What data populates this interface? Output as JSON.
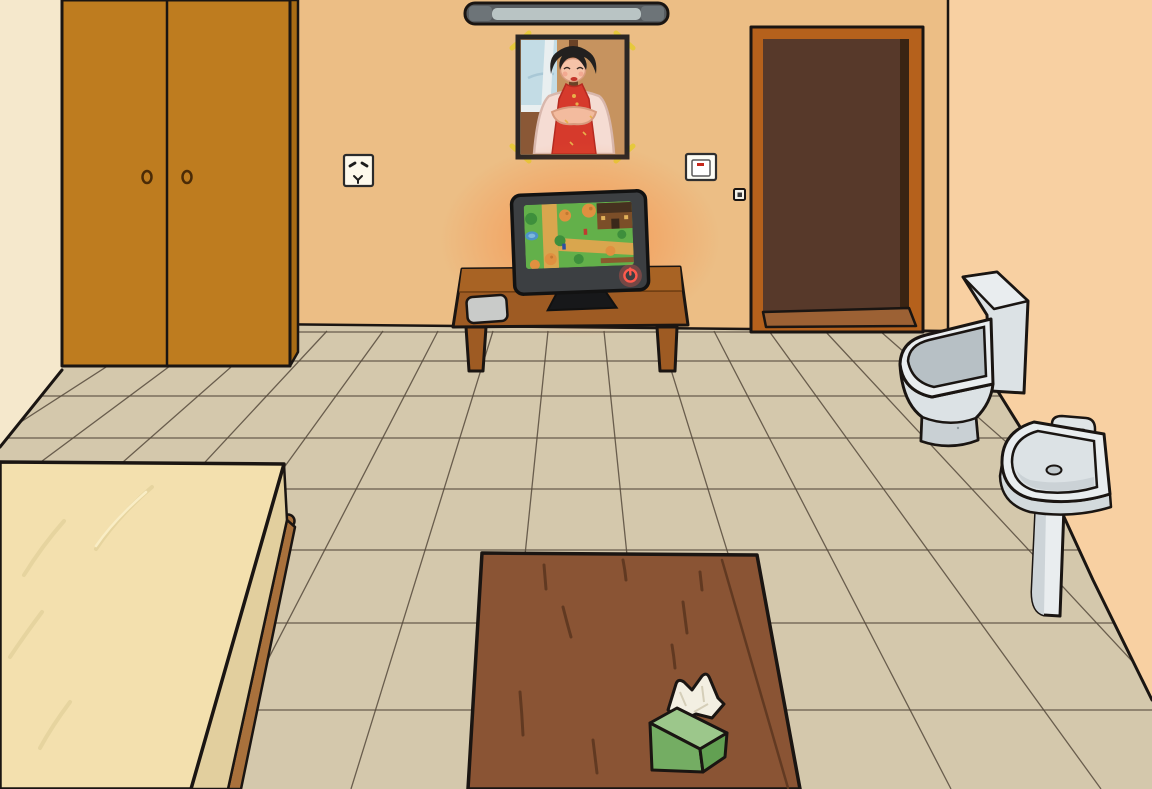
{
  "canvas": {
    "width": 1152,
    "height": 789
  },
  "scene_type": "cartoon room escape game scene",
  "palette": {
    "back_wall": "#ECBE85",
    "left_wall": "#F5E8CC",
    "right_wall": "#F8D0A2",
    "floor_tile": "#D4C8AC",
    "grout": "#564A3C",
    "outline": "#1A1512",
    "wardrobe": "#BE7C1F",
    "wardrobe_dark": "#A96C15",
    "door_frame": "#B5611C",
    "door_dark": "#57392A",
    "door_shadow": "#3A2413",
    "threshold": "#9C6134",
    "bed_mattress": "#F3E0AE",
    "bed_side": "#E2CF9E",
    "bed_frame": "#A9713C",
    "table_wood": "#9E5B23",
    "table_wood_light": "#A86324",
    "coffee_table": "#8A5434",
    "coffee_grain": "#5D3720",
    "ceramic": "#E9EDEF",
    "ceramic_mid": "#DCE2E5",
    "ceramic_dark": "#B7C0C5",
    "tissue_top": "#9CC78B",
    "tissue_front": "#74AD63",
    "tissue_side": "#62A052",
    "tissue_paper": "#F3EFE2",
    "tv_frame": "#3C3F42",
    "tv_glow": "#FF7323",
    "tv_power_red": "#FF5A4D",
    "screen_grass": "#63B04A",
    "screen_path": "#D9A64E",
    "lamp_body": "#575C60",
    "lamp_tube": "#B9C4C4",
    "lamp_cap": "#6D7478",
    "accent_red": "#D63A2C",
    "clip_yellow": "#E6C93C",
    "mat_grey": "#C9CBC9",
    "skin": "#F6C3A8",
    "shawl_pink": "#F5DCD3",
    "hair_black": "#22201F"
  },
  "objects": [
    {
      "id": "left-wall",
      "label": "left wall",
      "interactable": false
    },
    {
      "id": "back-wall",
      "label": "back wall",
      "interactable": false
    },
    {
      "id": "right-wall",
      "label": "right wall",
      "interactable": false
    },
    {
      "id": "floor",
      "label": "tiled floor",
      "interactable": false
    },
    {
      "id": "ceiling-lamp",
      "label": "fluorescent ceiling lamp",
      "interactable": true
    },
    {
      "id": "wardrobe",
      "label": "wooden two-door wardrobe",
      "interactable": true
    },
    {
      "id": "portrait",
      "label": "framed portrait of woman in red qipao",
      "interactable": true
    },
    {
      "id": "power-outlet",
      "label": "wall power outlet",
      "interactable": true
    },
    {
      "id": "light-switch",
      "label": "light switch with red indicator",
      "interactable": true
    },
    {
      "id": "doorbell-button",
      "label": "small button beside door",
      "interactable": true
    },
    {
      "id": "door",
      "label": "dark open doorway with wooden frame",
      "interactable": true
    },
    {
      "id": "tv",
      "label": "television playing pixel-art village game",
      "interactable": true
    },
    {
      "id": "tv-power-button",
      "label": "glowing TV power button",
      "interactable": true
    },
    {
      "id": "tv-table",
      "label": "wooden TV table",
      "interactable": true
    },
    {
      "id": "remote-pad",
      "label": "grey pad on TV table",
      "interactable": true
    },
    {
      "id": "toilet",
      "label": "white toilet",
      "interactable": true
    },
    {
      "id": "sink",
      "label": "white pedestal sink with faucet",
      "interactable": true
    },
    {
      "id": "bed",
      "label": "bed with cream mattress and wooden frame",
      "interactable": true
    },
    {
      "id": "coffee-table",
      "label": "wooden coffee table",
      "interactable": true
    },
    {
      "id": "tissue-box",
      "label": "green tissue box with tissue",
      "interactable": true
    }
  ]
}
